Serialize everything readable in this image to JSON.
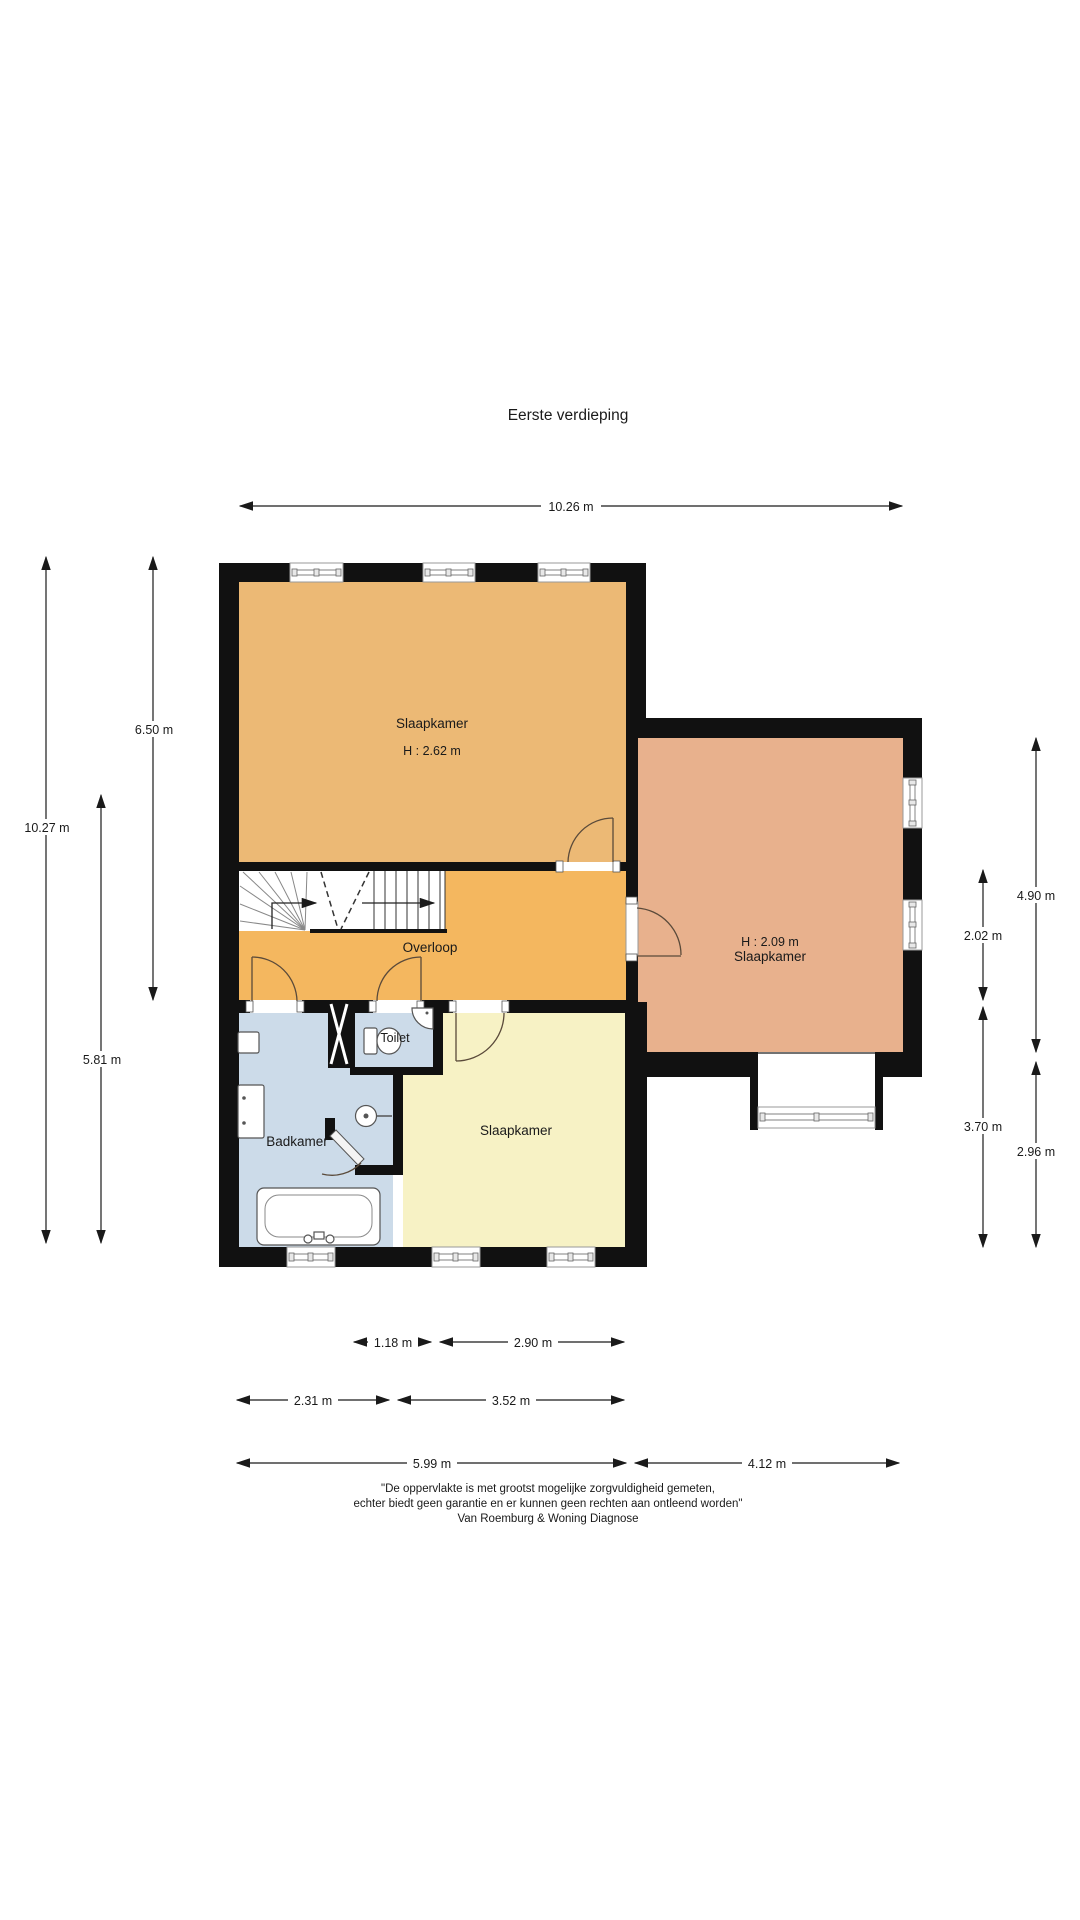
{
  "title": "Eerste verdieping",
  "rooms": {
    "bedroom_main": {
      "name": "Slaapkamer",
      "height": "H : 2.62 m",
      "color": "#ecb975"
    },
    "bedroom_right": {
      "name": "Slaapkamer",
      "height": "H : 2.09 m",
      "color": "#e8b18d"
    },
    "bedroom_bottom": {
      "name": "Slaapkamer",
      "color": "#f7f2c5"
    },
    "landing": {
      "name": "Overloop",
      "color": "#f4b75f"
    },
    "bathroom": {
      "name": "Badkamer",
      "color": "#ccdbe9"
    },
    "toilet": {
      "name": "Toilet",
      "color": "#ccdbe9"
    }
  },
  "dimensions": {
    "top_width": "10.26 m",
    "left_total": "10.27 m",
    "left_upper": "6.50 m",
    "left_lower": "5.81 m",
    "right_outer_upper": "4.90 m",
    "right_outer_lower": "2.96 m",
    "right_inner_upper": "2.02 m",
    "right_inner_lower": "3.70 m",
    "bottom_row1_left": "1.18 m",
    "bottom_row1_right": "2.90 m",
    "bottom_row2_left": "2.31 m",
    "bottom_row2_right": "3.52 m",
    "bottom_row3_left": "5.99 m",
    "bottom_row3_right": "4.12 m"
  },
  "disclaimer": {
    "line1": "\"De oppervlakte is met grootst mogelijke zorgvuldigheid gemeten,",
    "line2": "echter biedt geen garantie en er kunnen geen rechten aan ontleend worden\"",
    "line3": "Van Roemburg & Woning Diagnose"
  },
  "colors": {
    "wall": "#111111",
    "dimension_text": "#1a1a1a",
    "window_glass": "#9a9a9a"
  }
}
